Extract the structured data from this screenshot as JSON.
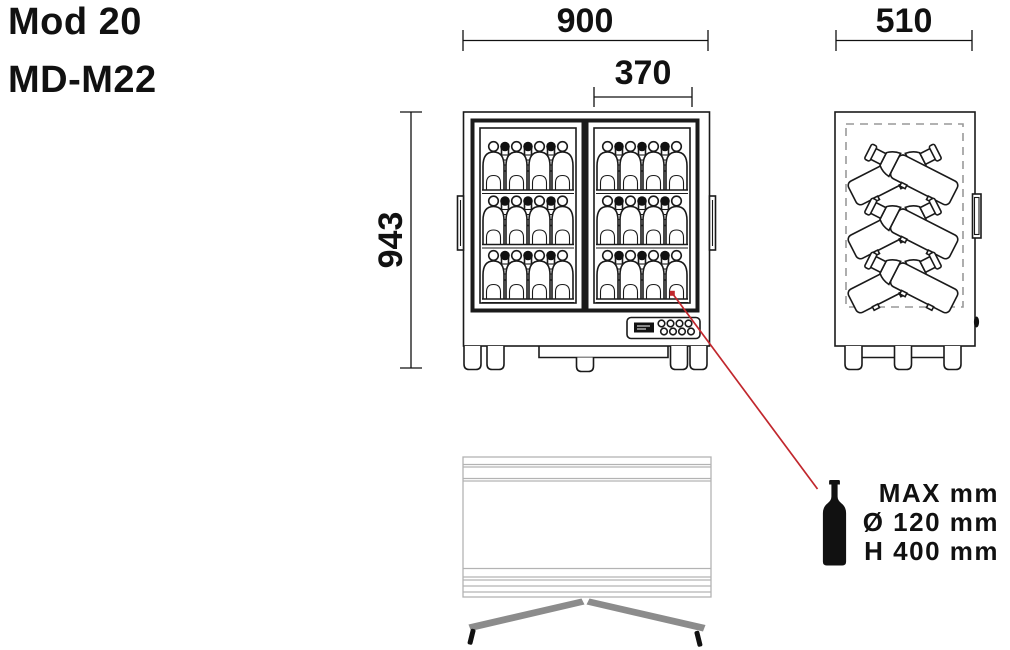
{
  "title": {
    "model": "Mod 20",
    "code": "MD-M22"
  },
  "dimensions": {
    "width_mm": "900",
    "door_opening_mm": "370",
    "height_mm": "943",
    "depth_mm": "510"
  },
  "bottle_limits": {
    "heading": "MAX mm",
    "diameter": "Ø 120 mm",
    "height": "H 400 mm"
  },
  "front_view": {
    "doors": 2,
    "shelves_per_door": 3,
    "front_bottles_per_shelf": 4,
    "rear_bottles_per_shelf": 3
  },
  "side_view": {
    "crossed_bottle_rows": 3
  },
  "colors": {
    "line_black": "#1a1a1a",
    "callout_red": "#c1272d",
    "top_view_gray": "#b3b3b3",
    "door_bar_gray": "#8c8c8c"
  }
}
